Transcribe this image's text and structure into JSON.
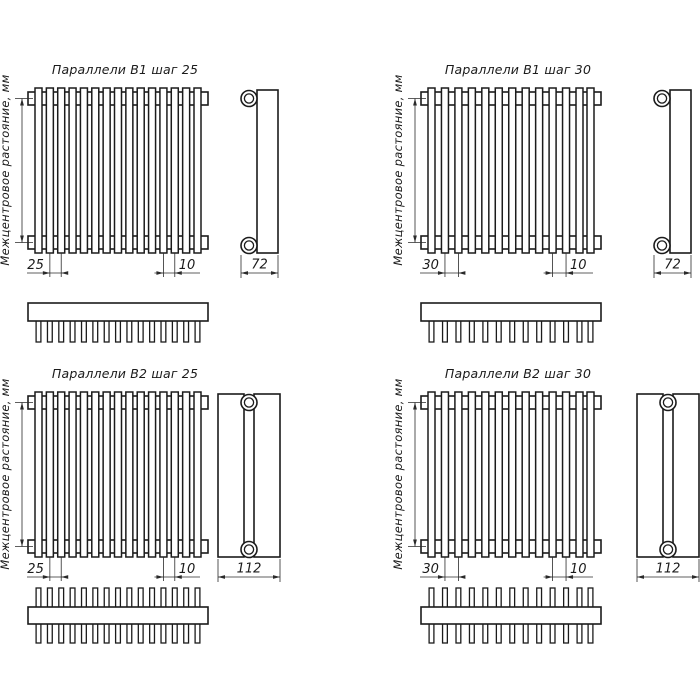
{
  "page": {
    "background": "#ffffff",
    "line_color": "#1b1b1b",
    "dim_line_color": "#2a2a2a"
  },
  "shared": {
    "center_distance_label": "Межцентровое растояние, мм",
    "units": "мм"
  },
  "variants": [
    {
      "id": "b1-step25",
      "title": "Параллели B1 шаг 25",
      "step_value": "25",
      "end_gap_value": "10",
      "depth_value": "72",
      "rows": 1,
      "tube_count": 15,
      "comb_teeth": 15
    },
    {
      "id": "b1-step30",
      "title": "Параллели B1 шаг 30",
      "step_value": "30",
      "end_gap_value": "10",
      "depth_value": "72",
      "rows": 1,
      "tube_count": 13,
      "comb_teeth": 13
    },
    {
      "id": "b2-step25",
      "title": "Параллели B2 шаг 25",
      "step_value": "25",
      "end_gap_value": "10",
      "depth_value": "112",
      "rows": 2,
      "tube_count": 15,
      "comb_teeth": 30
    },
    {
      "id": "b2-step30",
      "title": "Параллели B2 шаг 30",
      "step_value": "30",
      "end_gap_value": "10",
      "depth_value": "112",
      "rows": 2,
      "tube_count": 13,
      "comb_teeth": 26
    }
  ]
}
